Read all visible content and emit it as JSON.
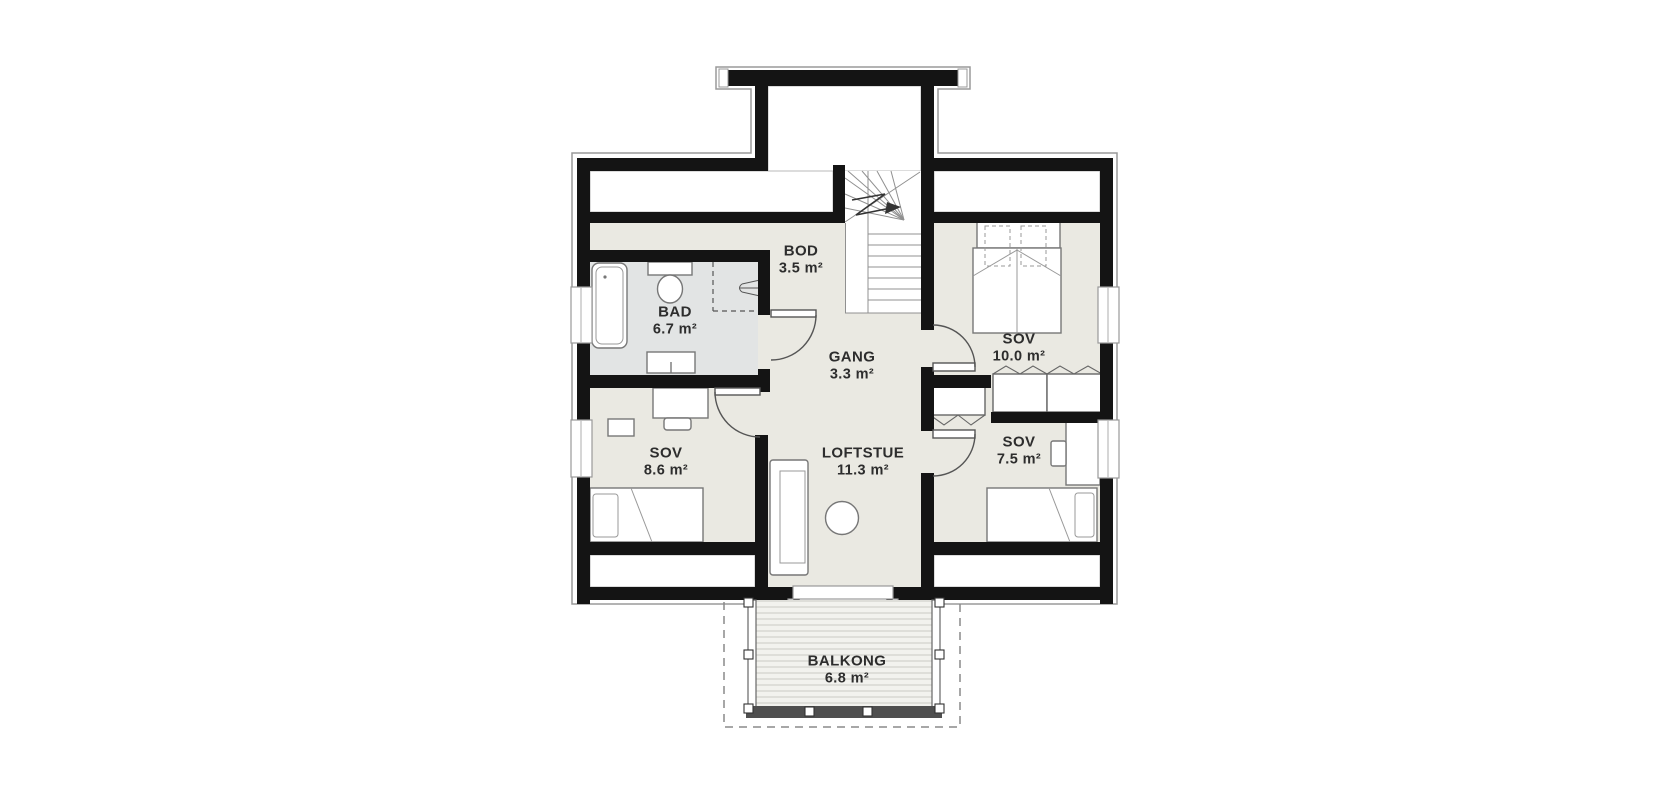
{
  "plan": {
    "rooms": [
      {
        "id": "bod",
        "name": "BOD",
        "area": "3.5 m²"
      },
      {
        "id": "bad",
        "name": "BAD",
        "area": "6.7 m²"
      },
      {
        "id": "gang",
        "name": "GANG",
        "area": "3.3 m²"
      },
      {
        "id": "sov1",
        "name": "SOV",
        "area": "10.0 m²"
      },
      {
        "id": "sov2",
        "name": "SOV",
        "area": "8.6 m²"
      },
      {
        "id": "loftstue",
        "name": "LOFTSTUE",
        "area": "11.3 m²"
      },
      {
        "id": "sov3",
        "name": "SOV",
        "area": "7.5 m²"
      },
      {
        "id": "balkong",
        "name": "BALKONG",
        "area": "6.8 m²"
      }
    ],
    "colors": {
      "wall": "#141414",
      "room_fill": "#eae9e2",
      "bath_fill": "#e2e4e4",
      "outline_gray": "#9a9a9a",
      "furniture_stroke": "#777777",
      "deck_stripe": "#d5d5d0"
    },
    "icons": [
      "staircase-up-arrow-icon",
      "extractor-fan-icon"
    ]
  }
}
